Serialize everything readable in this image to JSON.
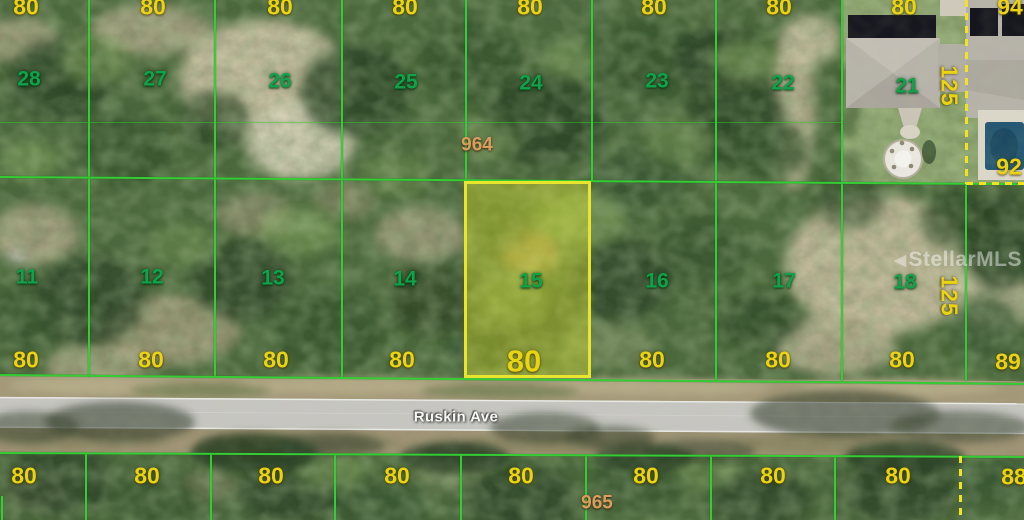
{
  "street": {
    "name": "Ruskin Ave"
  },
  "street_labels": [
    {
      "t": "Ruskin Ave",
      "x": 456,
      "y": 417
    }
  ],
  "watermark": {
    "text": "StellarMLS",
    "logo": "◀"
  },
  "blocks": [
    {
      "t": "964",
      "x": 477,
      "y": 145
    },
    {
      "t": "965",
      "x": 597,
      "y": 503
    }
  ],
  "highlight": {
    "lot": "15",
    "frontage": "80",
    "rect": {
      "x": 464,
      "y": 181,
      "w": 127,
      "h": 197
    }
  },
  "rows": {
    "top": {
      "lot_numbers": [
        {
          "t": "28",
          "x": 29,
          "y": 79
        },
        {
          "t": "27",
          "x": 155,
          "y": 79
        },
        {
          "t": "26",
          "x": 280,
          "y": 81
        },
        {
          "t": "25",
          "x": 406,
          "y": 82
        },
        {
          "t": "24",
          "x": 531,
          "y": 83
        },
        {
          "t": "23",
          "x": 657,
          "y": 81
        },
        {
          "t": "22",
          "x": 783,
          "y": 83
        },
        {
          "t": "21",
          "x": 907,
          "y": 86
        }
      ],
      "widths": [
        {
          "t": "80",
          "x": 26,
          "y": 7
        },
        {
          "t": "80",
          "x": 153,
          "y": 7
        },
        {
          "t": "80",
          "x": 280,
          "y": 7
        },
        {
          "t": "80",
          "x": 405,
          "y": 7
        },
        {
          "t": "80",
          "x": 530,
          "y": 7
        },
        {
          "t": "80",
          "x": 654,
          "y": 7
        },
        {
          "t": "80",
          "x": 779,
          "y": 7
        },
        {
          "t": "80",
          "x": 904,
          "y": 7
        }
      ]
    },
    "middle": {
      "lot_numbers": [
        {
          "t": "11",
          "x": 27,
          "y": 277
        },
        {
          "t": "12",
          "x": 152,
          "y": 277
        },
        {
          "t": "13",
          "x": 273,
          "y": 278
        },
        {
          "t": "14",
          "x": 405,
          "y": 279
        },
        {
          "t": "15",
          "x": 531,
          "y": 281
        },
        {
          "t": "16",
          "x": 657,
          "y": 281
        },
        {
          "t": "17",
          "x": 784,
          "y": 281
        },
        {
          "t": "18",
          "x": 905,
          "y": 282
        }
      ],
      "widths": [
        {
          "t": "80",
          "x": 26,
          "y": 360
        },
        {
          "t": "80",
          "x": 151,
          "y": 360
        },
        {
          "t": "80",
          "x": 276,
          "y": 360
        },
        {
          "t": "80",
          "x": 402,
          "y": 360
        },
        {
          "t": "80",
          "x": 524,
          "y": 361,
          "big": true
        },
        {
          "t": "80",
          "x": 652,
          "y": 360
        },
        {
          "t": "80",
          "x": 778,
          "y": 360
        },
        {
          "t": "80",
          "x": 902,
          "y": 360
        }
      ]
    },
    "bottom": {
      "widths": [
        {
          "t": "80",
          "x": 24,
          "y": 476
        },
        {
          "t": "80",
          "x": 147,
          "y": 476
        },
        {
          "t": "80",
          "x": 271,
          "y": 476
        },
        {
          "t": "80",
          "x": 397,
          "y": 476
        },
        {
          "t": "80",
          "x": 521,
          "y": 476
        },
        {
          "t": "80",
          "x": 646,
          "y": 476
        },
        {
          "t": "80",
          "x": 773,
          "y": 476
        },
        {
          "t": "80",
          "x": 898,
          "y": 476
        }
      ]
    }
  },
  "edge_labels": [
    {
      "t": "94",
      "x": 1010,
      "y": 7
    },
    {
      "t": "92",
      "x": 1009,
      "y": 167
    },
    {
      "t": "89",
      "x": 1008,
      "y": 362
    },
    {
      "t": "88",
      "x": 1014,
      "y": 477
    }
  ],
  "depth_labels": [
    {
      "t": "125",
      "x": 949,
      "y": 86,
      "rot": 90
    },
    {
      "t": "125",
      "x": 949,
      "y": 296,
      "rot": 90
    }
  ],
  "boundaries": {
    "vertical": [
      {
        "x": 89,
        "y1": 0,
        "y2": 181
      },
      {
        "x": 215,
        "y1": 0,
        "y2": 181
      },
      {
        "x": 342,
        "y1": 0,
        "y2": 182
      },
      {
        "x": 466,
        "y1": 0,
        "y2": 182
      },
      {
        "x": 592,
        "y1": 0,
        "y2": 182
      },
      {
        "x": 716,
        "y1": 0,
        "y2": 183
      },
      {
        "x": 842,
        "y1": 0,
        "y2": 183
      },
      {
        "x": 89,
        "y1": 179,
        "y2": 377
      },
      {
        "x": 215,
        "y1": 179,
        "y2": 377
      },
      {
        "x": 342,
        "y1": 180,
        "y2": 378
      },
      {
        "x": 716,
        "y1": 181,
        "y2": 380
      },
      {
        "x": 842,
        "y1": 182,
        "y2": 381
      },
      {
        "x": 966,
        "y1": 183,
        "y2": 381
      },
      {
        "x": 2,
        "y1": 496,
        "y2": 520
      },
      {
        "x": 86,
        "y1": 454,
        "y2": 520
      },
      {
        "x": 211,
        "y1": 454,
        "y2": 520
      },
      {
        "x": 335,
        "y1": 455,
        "y2": 520
      },
      {
        "x": 461,
        "y1": 455,
        "y2": 520
      },
      {
        "x": 586,
        "y1": 456,
        "y2": 520
      },
      {
        "x": 711,
        "y1": 456,
        "y2": 520
      },
      {
        "x": 835,
        "y1": 457,
        "y2": 520
      }
    ],
    "horizontal": [
      {
        "y": 123,
        "x1": 0,
        "x2": 843,
        "style": "faint"
      },
      {
        "y": 177,
        "x1": 0,
        "x2": 1024,
        "tilt": 0.4
      },
      {
        "y": 375,
        "x1": 0,
        "x2": 1024,
        "tilt": 0.5
      },
      {
        "y": 453,
        "x1": 0,
        "x2": 1024,
        "tilt": 0.22
      }
    ],
    "dashed_vertical": [
      {
        "x": 966,
        "y1": 0,
        "y2": 184
      },
      {
        "x": 960,
        "y1": 456,
        "y2": 520
      }
    ],
    "dashed_horizontal": [
      {
        "y": 183,
        "x1": 966,
        "x2": 1024
      }
    ]
  },
  "colors": {
    "boundary": "#35cd35",
    "highlight_border": "#e9e52c",
    "lot_number": "#10a24b",
    "width_label": "#e9d411",
    "block_label": "#db9d5e",
    "dashed": "#f2e223",
    "road_asphalt": "#c6c5c1"
  }
}
